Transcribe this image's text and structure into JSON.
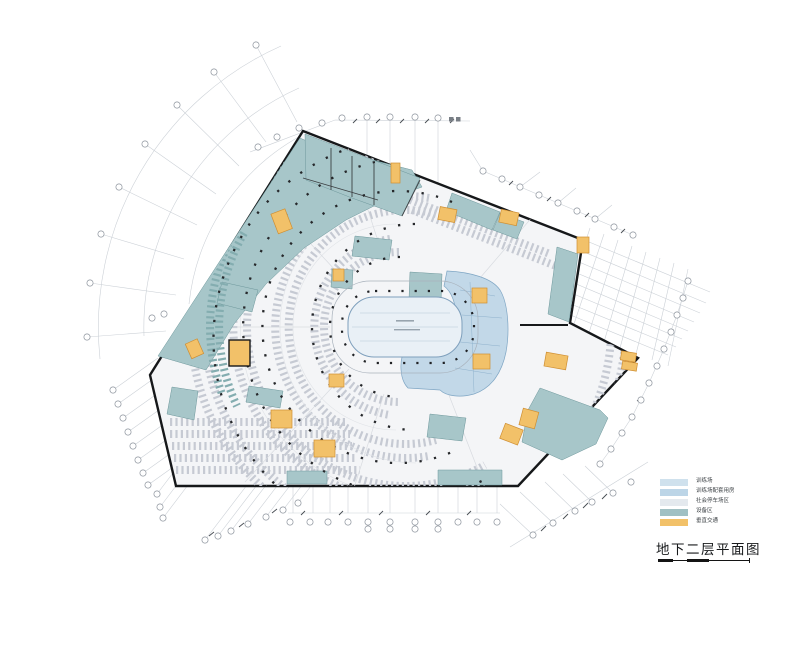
{
  "drawing": {
    "title": "地下二层平面图",
    "legend": {
      "items": [
        {
          "label": "训练场",
          "color": "#cfe1ed"
        },
        {
          "label": "训练场配套用房",
          "color": "#bcd5e7"
        },
        {
          "label": "社会停车场区",
          "color": "#e4e9ee"
        },
        {
          "label": "设备区",
          "color": "#a0c0c3"
        },
        {
          "label": "垂直交通",
          "color": "#f2c169"
        }
      ]
    },
    "colors": {
      "service_teal": "#a7c6c9",
      "rink_pale_blue": "#e9f0f6",
      "support_light_blue": "#c2d8e8",
      "parking_fill": "#f4f5f7",
      "stair_orange": "#f2c169",
      "outline_black": "#16181a",
      "grid_gray": "#ccd1d7"
    }
  }
}
